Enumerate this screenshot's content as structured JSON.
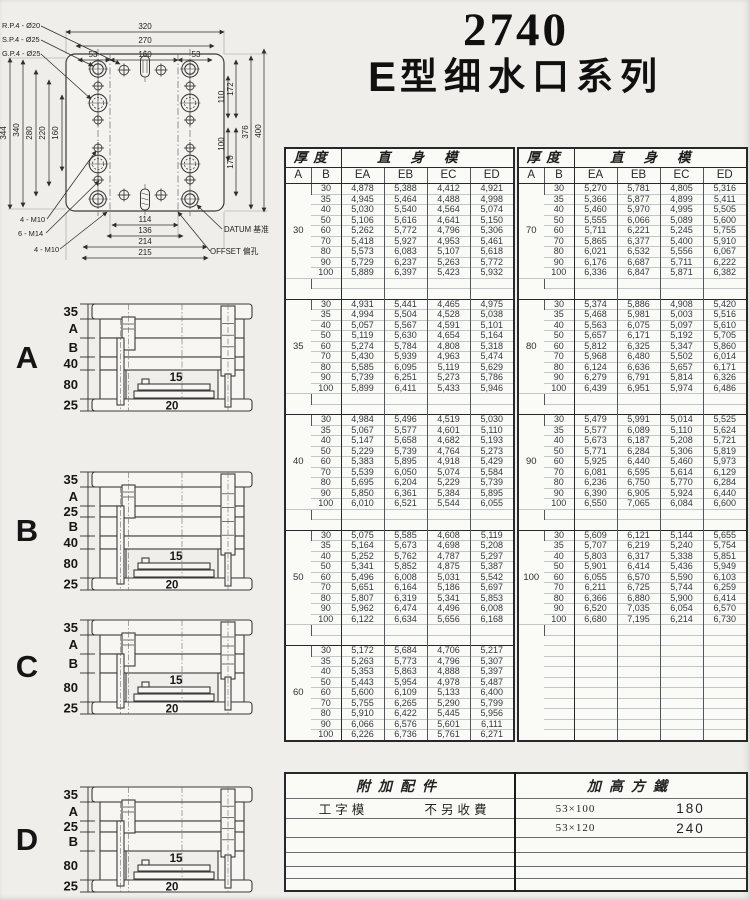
{
  "title": {
    "model": "2740",
    "series_prefix": "E",
    "series_rest": "型细水口系列"
  },
  "colors": {
    "ink": "#2a2a2a",
    "paper": "#efeeea",
    "table_bg": "#fafaf6"
  },
  "drawing": {
    "dims_top": [
      "320",
      "270",
      "53",
      "160",
      "53"
    ],
    "dims_left": [
      "344",
      "340",
      "280",
      "220",
      "160"
    ],
    "dims_right": [
      "172",
      "110",
      "100",
      "170",
      "376",
      "400"
    ],
    "dims_bottom": [
      "114",
      "136",
      "214",
      "215"
    ],
    "ann_left": [
      "R.P.4 - Ø20",
      "S.P.4 - Ø25",
      "G.P.4 - Ø25"
    ],
    "ann_bottom_left": [
      "4 - M10",
      "6 - M14",
      "4 - M10"
    ],
    "ann_bottom_right": [
      "DATUM 基准",
      "OFFSET 偏孔"
    ]
  },
  "diagrams": [
    {
      "letter": "A",
      "plates": [
        "35",
        "A",
        "B",
        "40",
        "80",
        "25"
      ],
      "inner_labels": [
        "15",
        "20"
      ]
    },
    {
      "letter": "B",
      "plates": [
        "35",
        "A",
        "25",
        "B",
        "40",
        "80",
        "25"
      ],
      "inner_labels": [
        "15",
        "20"
      ]
    },
    {
      "letter": "C",
      "plates": [
        "35",
        "A",
        "B",
        "80",
        "25"
      ],
      "inner_labels": [
        "15",
        "20"
      ]
    },
    {
      "letter": "D",
      "plates": [
        "35",
        "A",
        "25",
        "B",
        "80",
        "25"
      ],
      "inner_labels": [
        "15",
        "20"
      ]
    }
  ],
  "tables": {
    "header": {
      "group_left": "厚度",
      "group_right": "直身模",
      "cols": [
        "A",
        "B",
        "EA",
        "EB",
        "EC",
        "ED"
      ]
    },
    "left_blocks": [
      {
        "a": "30",
        "rows": [
          [
            "30",
            "4,878",
            "5,388",
            "4,412",
            "4,921"
          ],
          [
            "35",
            "4,945",
            "5,464",
            "4,488",
            "4,998"
          ],
          [
            "40",
            "5,030",
            "5,540",
            "4,564",
            "5,074"
          ],
          [
            "50",
            "5,106",
            "5,616",
            "4,641",
            "5,150"
          ],
          [
            "60",
            "5,262",
            "5,772",
            "4,796",
            "5,306"
          ],
          [
            "70",
            "5,418",
            "5,927",
            "4,953",
            "5,461"
          ],
          [
            "80",
            "5,573",
            "6,083",
            "5,107",
            "5,618"
          ],
          [
            "90",
            "5,729",
            "6,237",
            "5,263",
            "5,772"
          ],
          [
            "100",
            "5,889",
            "6,397",
            "5,423",
            "5,932"
          ]
        ]
      },
      {
        "a": "35",
        "rows": [
          [
            "30",
            "4,931",
            "5,441",
            "4,465",
            "4,975"
          ],
          [
            "35",
            "4,994",
            "5,504",
            "4,528",
            "5,038"
          ],
          [
            "40",
            "5,057",
            "5,567",
            "4,591",
            "5,101"
          ],
          [
            "50",
            "5,119",
            "5,630",
            "4,654",
            "5,164"
          ],
          [
            "60",
            "5,274",
            "5,784",
            "4,808",
            "5,318"
          ],
          [
            "70",
            "5,430",
            "5,939",
            "4,963",
            "5,474"
          ],
          [
            "80",
            "5,585",
            "6,095",
            "5,119",
            "5,629"
          ],
          [
            "90",
            "5,739",
            "6,251",
            "5,273",
            "5,786"
          ],
          [
            "100",
            "5,899",
            "6,411",
            "5,433",
            "5,946"
          ]
        ]
      },
      {
        "a": "40",
        "rows": [
          [
            "30",
            "4,984",
            "5,496",
            "4,519",
            "5,030"
          ],
          [
            "35",
            "5,067",
            "5,577",
            "4,601",
            "5,110"
          ],
          [
            "40",
            "5,147",
            "5,658",
            "4,682",
            "5,193"
          ],
          [
            "50",
            "5,229",
            "5,739",
            "4,764",
            "5,273"
          ],
          [
            "60",
            "5,383",
            "5,895",
            "4,918",
            "5,429"
          ],
          [
            "70",
            "5,539",
            "6,050",
            "5,074",
            "5,584"
          ],
          [
            "80",
            "5,695",
            "6,204",
            "5,229",
            "5,739"
          ],
          [
            "90",
            "5,850",
            "6,361",
            "5,384",
            "5,895"
          ],
          [
            "100",
            "6,010",
            "6,521",
            "5,544",
            "6,055"
          ]
        ]
      },
      {
        "a": "50",
        "rows": [
          [
            "30",
            "5,075",
            "5,585",
            "4,608",
            "5,119"
          ],
          [
            "35",
            "5,164",
            "5,673",
            "4,698",
            "5,208"
          ],
          [
            "40",
            "5,252",
            "5,762",
            "4,787",
            "5,297"
          ],
          [
            "50",
            "5,341",
            "5,852",
            "4,875",
            "5,387"
          ],
          [
            "60",
            "5,496",
            "6,008",
            "5,031",
            "5,542"
          ],
          [
            "70",
            "5,651",
            "6,164",
            "5,186",
            "5,697"
          ],
          [
            "80",
            "5,807",
            "6,319",
            "5,341",
            "5,853"
          ],
          [
            "90",
            "5,962",
            "6,474",
            "4,496",
            "6,008"
          ],
          [
            "100",
            "6,122",
            "6,634",
            "5,656",
            "6,168"
          ]
        ]
      },
      {
        "a": "60",
        "rows": [
          [
            "30",
            "5,172",
            "5,684",
            "4,706",
            "5,217"
          ],
          [
            "35",
            "5,263",
            "5,773",
            "4,796",
            "5,307"
          ],
          [
            "40",
            "5,353",
            "5,863",
            "4,888",
            "5,397"
          ],
          [
            "50",
            "5,443",
            "5,954",
            "4,978",
            "5,487"
          ],
          [
            "60",
            "5,600",
            "6,109",
            "5,133",
            "6,400"
          ],
          [
            "70",
            "5,755",
            "6,265",
            "5,290",
            "5,799"
          ],
          [
            "80",
            "5,910",
            "6,422",
            "5,445",
            "5,956"
          ],
          [
            "90",
            "6,066",
            "6,576",
            "5,601",
            "6,111"
          ],
          [
            "100",
            "6,226",
            "6,736",
            "5,761",
            "6,271"
          ]
        ]
      }
    ],
    "right_blocks": [
      {
        "a": "70",
        "rows": [
          [
            "30",
            "5,270",
            "5,781",
            "4,805",
            "5,316"
          ],
          [
            "35",
            "5,366",
            "5,877",
            "4,899",
            "5,411"
          ],
          [
            "40",
            "5,460",
            "5,970",
            "4,995",
            "5,505"
          ],
          [
            "50",
            "5,555",
            "6,066",
            "5,089",
            "5,600"
          ],
          [
            "60",
            "5,711",
            "6,221",
            "5,245",
            "5,755"
          ],
          [
            "70",
            "5,865",
            "6,377",
            "5,400",
            "5,910"
          ],
          [
            "80",
            "6,021",
            "6,532",
            "5,556",
            "6,067"
          ],
          [
            "90",
            "6,176",
            "6,687",
            "5,711",
            "6,222"
          ],
          [
            "100",
            "6,336",
            "6,847",
            "5,871",
            "6,382"
          ]
        ]
      },
      {
        "a": "80",
        "rows": [
          [
            "30",
            "5,374",
            "5,886",
            "4,908",
            "5,420"
          ],
          [
            "35",
            "5,468",
            "5,981",
            "5,003",
            "5,516"
          ],
          [
            "40",
            "5,563",
            "6,075",
            "5,097",
            "5,610"
          ],
          [
            "50",
            "5,657",
            "6,171",
            "5,192",
            "5,705"
          ],
          [
            "60",
            "5,812",
            "6,325",
            "5,347",
            "5,860"
          ],
          [
            "70",
            "5,968",
            "6,480",
            "5,502",
            "6,014"
          ],
          [
            "80",
            "6,124",
            "6,636",
            "5,657",
            "6,171"
          ],
          [
            "90",
            "6,279",
            "6,791",
            "5,814",
            "6,326"
          ],
          [
            "100",
            "6,439",
            "6,951",
            "5,974",
            "6,486"
          ]
        ]
      },
      {
        "a": "90",
        "rows": [
          [
            "30",
            "5,479",
            "5,991",
            "5,014",
            "5,525"
          ],
          [
            "35",
            "5,577",
            "6,089",
            "5,110",
            "5,624"
          ],
          [
            "40",
            "5,673",
            "6,187",
            "5,208",
            "5,721"
          ],
          [
            "50",
            "5,771",
            "6,284",
            "5,306",
            "5,819"
          ],
          [
            "60",
            "5,925",
            "6,440",
            "5,460",
            "5,973"
          ],
          [
            "70",
            "6,081",
            "6,595",
            "5,614",
            "6,129"
          ],
          [
            "80",
            "6,236",
            "6,750",
            "5,770",
            "6,284"
          ],
          [
            "90",
            "6,390",
            "6,905",
            "5,924",
            "6,440"
          ],
          [
            "100",
            "6,550",
            "7,065",
            "6,084",
            "6,600"
          ]
        ]
      },
      {
        "a": "100",
        "rows": [
          [
            "30",
            "5,609",
            "6,121",
            "5,144",
            "5,655"
          ],
          [
            "35",
            "5,707",
            "6,219",
            "5,240",
            "5,754"
          ],
          [
            "40",
            "5,803",
            "6,317",
            "5,338",
            "5,851"
          ],
          [
            "50",
            "5,901",
            "6,414",
            "5,436",
            "5,949"
          ],
          [
            "60",
            "6,055",
            "6,570",
            "5,590",
            "6,103"
          ],
          [
            "70",
            "6,211",
            "6,725",
            "5,744",
            "6,259"
          ],
          [
            "80",
            "6,366",
            "6,880",
            "5,900",
            "6,414"
          ],
          [
            "90",
            "6,520",
            "7,035",
            "6,054",
            "6,570"
          ],
          [
            "100",
            "6,680",
            "7,195",
            "6,214",
            "6,730"
          ]
        ]
      }
    ]
  },
  "accessories": {
    "header_left": "附加配件",
    "header_right": "加高方鐵",
    "rows": [
      [
        "工字模",
        "不另收費",
        "53×100",
        "180"
      ],
      [
        "",
        "",
        "53×120",
        "240"
      ],
      [
        "",
        "",
        "",
        ""
      ],
      [
        "",
        "",
        "",
        ""
      ],
      [
        "",
        "",
        "",
        ""
      ],
      [
        "",
        "",
        "",
        ""
      ]
    ]
  }
}
